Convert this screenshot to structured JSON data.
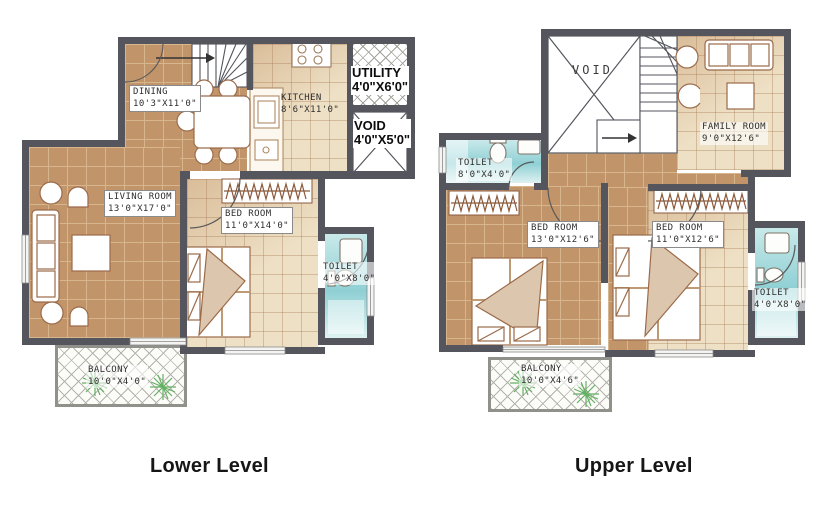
{
  "lower": {
    "caption": "Lower Level",
    "dining": {
      "name": "DINING",
      "dims": "10'3\"X11'0\""
    },
    "kitchen": {
      "name": "KITCHEN",
      "dims": "8'6\"X11'0\""
    },
    "utility": {
      "name": "UTILITY",
      "dims": "4'0\"X6'0\""
    },
    "void": {
      "name": "VOID",
      "dims": "4'0\"X5'0\""
    },
    "living": {
      "name": "LIVING ROOM",
      "dims": "13'0\"X17'0\""
    },
    "bedroom": {
      "name": "BED ROOM",
      "dims": "11'0\"X14'0\""
    },
    "toilet": {
      "name": "TOILET",
      "dims": "4'0\"X8'0\""
    },
    "balcony": {
      "name": "BALCONY",
      "dims": "10'0\"X4'0\""
    }
  },
  "upper": {
    "caption": "Upper Level",
    "void": {
      "name": "VOID"
    },
    "family": {
      "name": "FAMILY  ROOM",
      "dims": "9'0\"X12'6\""
    },
    "toilet_left": {
      "name": "TOILET",
      "dims": "8'0\"X4'0\""
    },
    "bedroom_left": {
      "name": "BED ROOM",
      "dims": "13'0\"X12'6\""
    },
    "bedroom_right": {
      "name": "BED ROOM",
      "dims": "11'0\"X12'6\""
    },
    "toilet_right": {
      "name": "TOILET",
      "dims": "4'0\"X8'0\""
    },
    "balcony": {
      "name": "BALCONY",
      "dims": "10'0\"X4'6\""
    }
  },
  "palette": {
    "wall": "#54555d",
    "floor_tan": "#c2946a",
    "floor_cream": "#eee0c5",
    "toilet_blue": "#8fd0d4",
    "plant_green": "#63b063",
    "furniture_outline": "#9b6b4a",
    "label_text": "#2f2f2f"
  }
}
